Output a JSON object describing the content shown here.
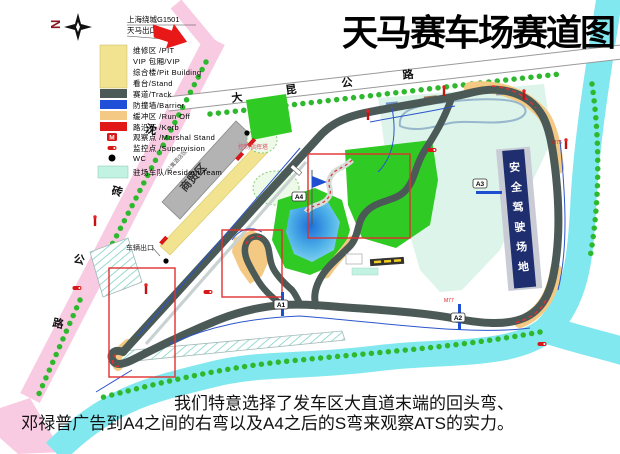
{
  "title": "天马赛车场赛道图",
  "compass": {
    "label": "N"
  },
  "highway_note": {
    "line1": "上海绕城G1501",
    "line2": "天马出口"
  },
  "legend": {
    "items": [
      {
        "label": "维修区 /PIT",
        "color": "#f2e390"
      },
      {
        "label": "VIP 包厢/VIP",
        "color": "#f2e390"
      },
      {
        "label": "综合楼/Pit Building",
        "color": "#f2e390"
      },
      {
        "label": "看台/Stand",
        "color": "#f2e390"
      },
      {
        "label": "赛道/Track",
        "color": "#4b5a56"
      },
      {
        "label": "防撞墙/Barrier",
        "color": "#2150d8"
      },
      {
        "label": "缓冲区 /Run Off",
        "color": "#f4c983"
      },
      {
        "label": "路沿石 /Kerb",
        "color": "#e01818"
      },
      {
        "label": "观察点 /Marshal Stand",
        "icon": "marshal-stand-icon"
      },
      {
        "label": "监控点 /Supervision",
        "icon": "supervision-icon"
      },
      {
        "label": "WC",
        "icon": "wc-dot-icon"
      },
      {
        "label": "驻场车队/Resident Team",
        "color": "#c2f2e2"
      }
    ]
  },
  "roads": {
    "top_road_chars": [
      "大",
      "昆",
      "公",
      "路"
    ],
    "left_road_chars": [
      "沈",
      "砖",
      "公",
      "路"
    ]
  },
  "map": {
    "trade_zone": "商贸区",
    "hotel_zone": "公寓酒店区",
    "control_tower": "控制指挥塔",
    "safe_driving_chars": [
      "安",
      "全",
      "驾",
      "驶",
      "场",
      "地"
    ],
    "vehicle_exit": "车辆出口",
    "corners": {
      "a1": "A1",
      "a2": "A2",
      "a3": "A3",
      "a4": "A4"
    },
    "marshal_posts": [
      "M75",
      "M77"
    ]
  },
  "caption": {
    "line1": "我们特意选择了发车区大直道末端的回头弯、",
    "line2": "邓禄普广告到A4之间的右弯以及A4之后的S弯来观察ATS的实力。"
  }
}
